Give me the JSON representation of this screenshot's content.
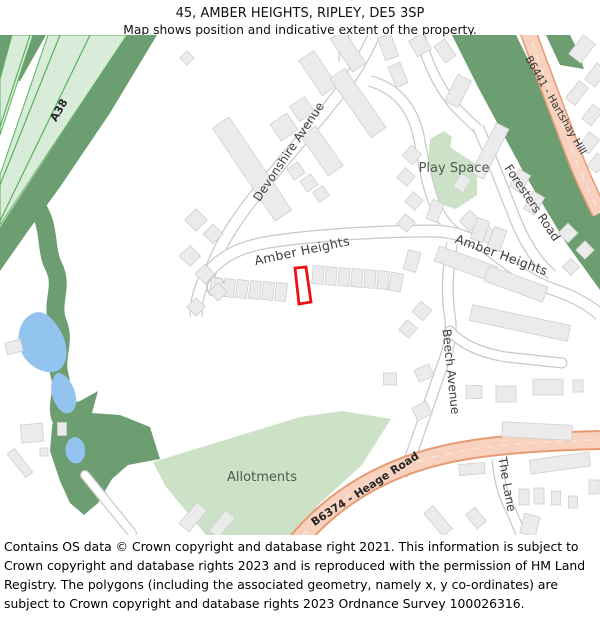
{
  "header": {
    "title": "45, AMBER HEIGHTS, RIPLEY, DE5 3SP",
    "subtitle": "Map shows position and indicative extent of the property."
  },
  "footer": {
    "text": "Contains OS data © Crown copyright and database right 2021. This information is subject to Crown copyright and database rights 2023 and is reproduced with the permission of HM Land Registry. The polygons (including the associated geometry, namely x, y co-ordinates) are subject to Crown copyright and database rights 2023 Ordnance Survey 100026316."
  },
  "map": {
    "labels": {
      "a38": "A38",
      "b6441": "B6441 - Hartshay Hill",
      "b6374": "B6374 - Heage Road",
      "devonshire_avenue": "Devonshire Avenue",
      "amber_heights_west": "Amber Heights",
      "amber_heights_east": "Amber Heights",
      "foresters_road": "Foresters Road",
      "beech_avenue": "Beech Avenue",
      "the_lane": "The Lane",
      "play_space": "Play Space",
      "allotments": "Allotments"
    },
    "colors": {
      "woodland": "#6d9e71",
      "greenspace": "#cbe2c6",
      "water": "#93c4ef",
      "a_road_fill": "#d9ecd9",
      "a_road_line": "#58b25b",
      "b_road_fill": "#f8d2bf",
      "b_road_border": "#e89a72",
      "building_fill": "#ebebeb",
      "building_stroke": "#cfcfcf",
      "road_casing": "#c9c9c9",
      "property_outline": "#ee1010"
    },
    "property_outline_points": "295,233 306,232 311,267 299,269",
    "buildings": [
      [
        252,
        134,
        20,
        112,
        -34
      ],
      [
        284,
        92,
        20,
        20,
        -34
      ],
      [
        302,
        74,
        18,
        18,
        -34
      ],
      [
        318,
        38,
        18,
        42,
        -34
      ],
      [
        348,
        16,
        16,
        40,
        -34
      ],
      [
        187,
        23,
        10,
        10,
        45
      ],
      [
        322,
        116,
        18,
        48,
        -35
      ],
      [
        358,
        68,
        18,
        72,
        -35
      ],
      [
        296,
        136,
        13,
        13,
        -35
      ],
      [
        309,
        148,
        13,
        13,
        -35
      ],
      [
        321,
        159,
        12,
        12,
        -35
      ],
      [
        388,
        12,
        14,
        24,
        -20
      ],
      [
        420,
        10,
        16,
        18,
        -30
      ],
      [
        398,
        40,
        13,
        22,
        -22
      ],
      [
        458,
        56,
        15,
        30,
        27
      ],
      [
        445,
        16,
        13,
        20,
        -35
      ],
      [
        582,
        14,
        15,
        24,
        38
      ],
      [
        596,
        40,
        13,
        20,
        38
      ],
      [
        577,
        58,
        12,
        22,
        38
      ],
      [
        592,
        80,
        12,
        18,
        38
      ],
      [
        589,
        108,
        13,
        18,
        38
      ],
      [
        597,
        128,
        12,
        16,
        38
      ],
      [
        490,
        116,
        14,
        56,
        27
      ],
      [
        520,
        146,
        13,
        20,
        30
      ],
      [
        534,
        168,
        13,
        20,
        30
      ],
      [
        470,
        186,
        15,
        15,
        45
      ],
      [
        487,
        199,
        13,
        13,
        45
      ],
      [
        412,
        120,
        14,
        14,
        40
      ],
      [
        406,
        142,
        13,
        13,
        40
      ],
      [
        414,
        166,
        13,
        13,
        40
      ],
      [
        406,
        188,
        13,
        13,
        40
      ],
      [
        462,
        148,
        12,
        16,
        30
      ],
      [
        216,
        252,
        11,
        18,
        8
      ],
      [
        229,
        253,
        11,
        18,
        8
      ],
      [
        242,
        254,
        11,
        18,
        8
      ],
      [
        255,
        255,
        11,
        18,
        8
      ],
      [
        268,
        256,
        11,
        18,
        8
      ],
      [
        281,
        257,
        11,
        18,
        8
      ],
      [
        318,
        240,
        11,
        18,
        5
      ],
      [
        331,
        241,
        11,
        18,
        5
      ],
      [
        344,
        242,
        11,
        18,
        5
      ],
      [
        357,
        243,
        11,
        18,
        5
      ],
      [
        370,
        244,
        11,
        18,
        5
      ],
      [
        383,
        245,
        11,
        18,
        5
      ],
      [
        396,
        247,
        12,
        18,
        10
      ],
      [
        412,
        226,
        13,
        20,
        16
      ],
      [
        466,
        229,
        62,
        16,
        20
      ],
      [
        516,
        249,
        62,
        16,
        20
      ],
      [
        480,
        195,
        13,
        22,
        20
      ],
      [
        497,
        204,
        13,
        22,
        20
      ],
      [
        435,
        176,
        12,
        20,
        20
      ],
      [
        568,
        198,
        14,
        14,
        45
      ],
      [
        585,
        215,
        13,
        13,
        45
      ],
      [
        571,
        232,
        12,
        12,
        45
      ],
      [
        196,
        185,
        16,
        16,
        45
      ],
      [
        213,
        199,
        14,
        14,
        45
      ],
      [
        190,
        221,
        15,
        15,
        45
      ],
      [
        205,
        239,
        14,
        14,
        45
      ],
      [
        218,
        257,
        13,
        13,
        45
      ],
      [
        196,
        272,
        13,
        13,
        45
      ],
      [
        32,
        398,
        22,
        18,
        -5
      ],
      [
        62,
        394,
        9,
        13,
        0
      ],
      [
        20,
        428,
        9,
        30,
        -38
      ],
      [
        44,
        417,
        8,
        8,
        0
      ],
      [
        14,
        312,
        16,
        12,
        -15
      ],
      [
        193,
        482,
        13,
        28,
        40
      ],
      [
        222,
        489,
        12,
        26,
        40
      ],
      [
        520,
        288,
        100,
        16,
        12
      ],
      [
        474,
        357,
        16,
        13,
        0
      ],
      [
        506,
        359,
        20,
        16,
        0
      ],
      [
        548,
        352,
        30,
        16,
        0
      ],
      [
        578,
        351,
        10,
        12,
        0
      ],
      [
        537,
        396,
        70,
        15,
        3
      ],
      [
        408,
        294,
        13,
        13,
        40
      ],
      [
        422,
        276,
        14,
        14,
        40
      ],
      [
        424,
        338,
        16,
        13,
        -25
      ],
      [
        422,
        376,
        16,
        14,
        -25
      ],
      [
        390,
        344,
        13,
        12,
        0
      ],
      [
        560,
        428,
        60,
        14,
        -8
      ],
      [
        472,
        434,
        26,
        11,
        -5
      ],
      [
        524,
        462,
        10,
        16,
        0
      ],
      [
        539,
        461,
        10,
        16,
        0
      ],
      [
        556,
        463,
        9,
        14,
        0
      ],
      [
        573,
        467,
        9,
        12,
        0
      ],
      [
        530,
        490,
        16,
        20,
        15
      ],
      [
        476,
        483,
        12,
        18,
        -40
      ],
      [
        438,
        486,
        12,
        30,
        -40
      ],
      [
        594,
        452,
        10,
        14,
        0
      ]
    ]
  }
}
